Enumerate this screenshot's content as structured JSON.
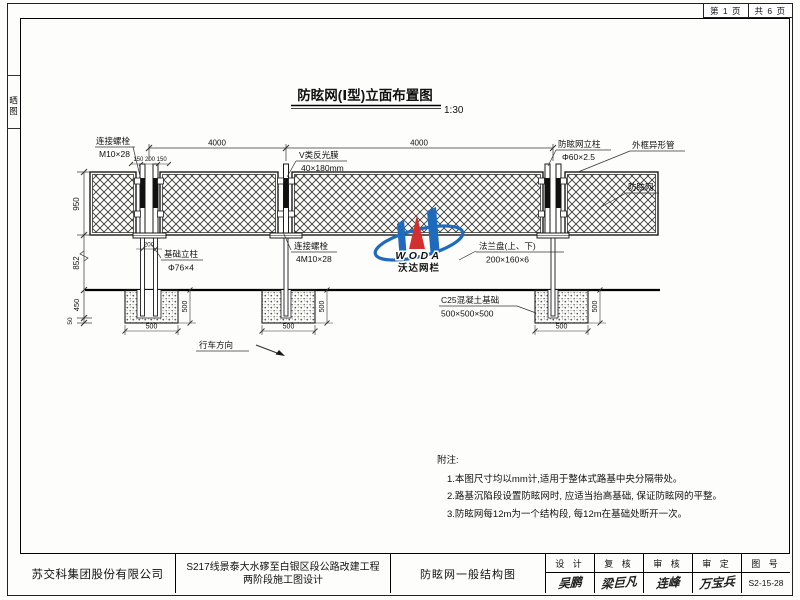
{
  "page_header": {
    "page": "第 1 页",
    "total": "共 6 页"
  },
  "side_tab": {
    "label": "晒图"
  },
  "drawing": {
    "title": "防眩网(Ⅰ型)立面布置图",
    "scale": "1:30",
    "dims": {
      "span": "4000",
      "post_spacing": "150 200 150",
      "mesh_height": "950",
      "post_below": "852",
      "embed": "450",
      "cushion": "50",
      "flange_span": "200",
      "foundation": "500"
    },
    "labels": {
      "bolt_top_1": "连接螺栓",
      "bolt_top_2": "M10×28",
      "film_1": "V类反光膜",
      "film_2": "40×180mm",
      "post_1": "防眩网立柱",
      "post_2": "Φ60×2.5",
      "frame": "外框异形管",
      "net": "防眩网",
      "bolt_mid_1": "连接螺栓",
      "bolt_mid_2": "4M10×28",
      "base_post_1": "基础立柱",
      "base_post_2": "Φ76×4",
      "flange_1": "法兰盘(上、下)",
      "flange_2": "200×160×6",
      "foundation_1": "C25混凝土基础",
      "foundation_2": "500×500×500",
      "direction": "行车方向"
    },
    "logo": {
      "latin": "WODA",
      "cjk": "沃达网栏"
    }
  },
  "notes": {
    "title": "附注:",
    "items": [
      "1.本图尺寸均以mm计,适用于整体式路基中央分隔带处。",
      "2.路基沉陷段设置防眩网时, 应适当抬高基础, 保证防眩网的平整。",
      "3.防眩网每12m为一个结构段, 每12m在基础处断开一次。"
    ]
  },
  "title_block": {
    "company": "苏交科集团股份有限公司",
    "project_line1": "S217线景泰大水䃎至白银区段公路改建工程",
    "project_line2": "两阶段施工图设计",
    "drawing_name": "防眩网一般结构图",
    "sign_columns": [
      {
        "header": "设 计",
        "signature": "吴鹏"
      },
      {
        "header": "复 核",
        "signature": "梁巨凡"
      },
      {
        "header": "审 核",
        "signature": "连峰"
      },
      {
        "header": "审 定",
        "signature": "万宝兵"
      }
    ],
    "number_header": "图 号",
    "number": "S2-15-28"
  }
}
